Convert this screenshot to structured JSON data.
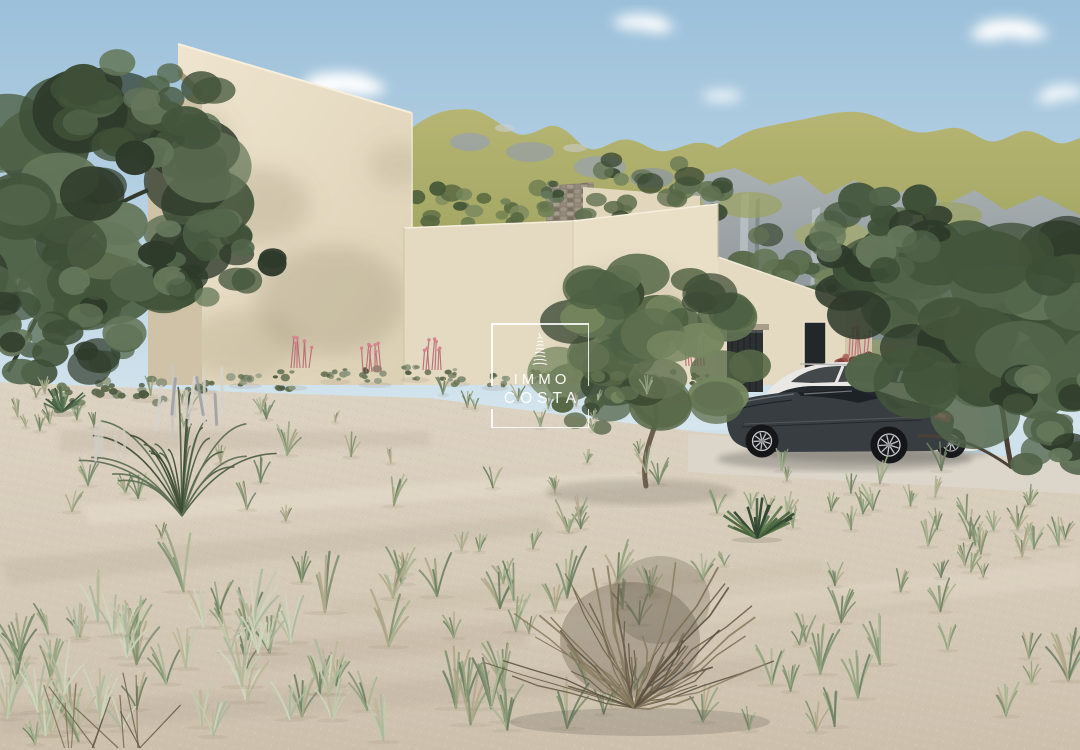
{
  "watermark": {
    "line1": "IMMO",
    "line2": "COSTA",
    "icon": "tower-icon",
    "color": "#ffffff"
  },
  "palette": {
    "sky_top": "#9cc0da",
    "sky_horizon": "#cfe2ec",
    "mountain_grass": "#aeae6a",
    "mountain_rock": "#8d979f",
    "villa_wall_lit": "#ebe1ca",
    "villa_wall_shade": "#cfc2a6",
    "stone_wall": "#8a8173",
    "garage_door": "#2c3031",
    "sand": "#d8cdbb",
    "foliage_dark": "#3c4a34",
    "flower_pink": "#c9707f",
    "car_dark_gray": "#383d42",
    "car_white": "#e9e8e4"
  }
}
